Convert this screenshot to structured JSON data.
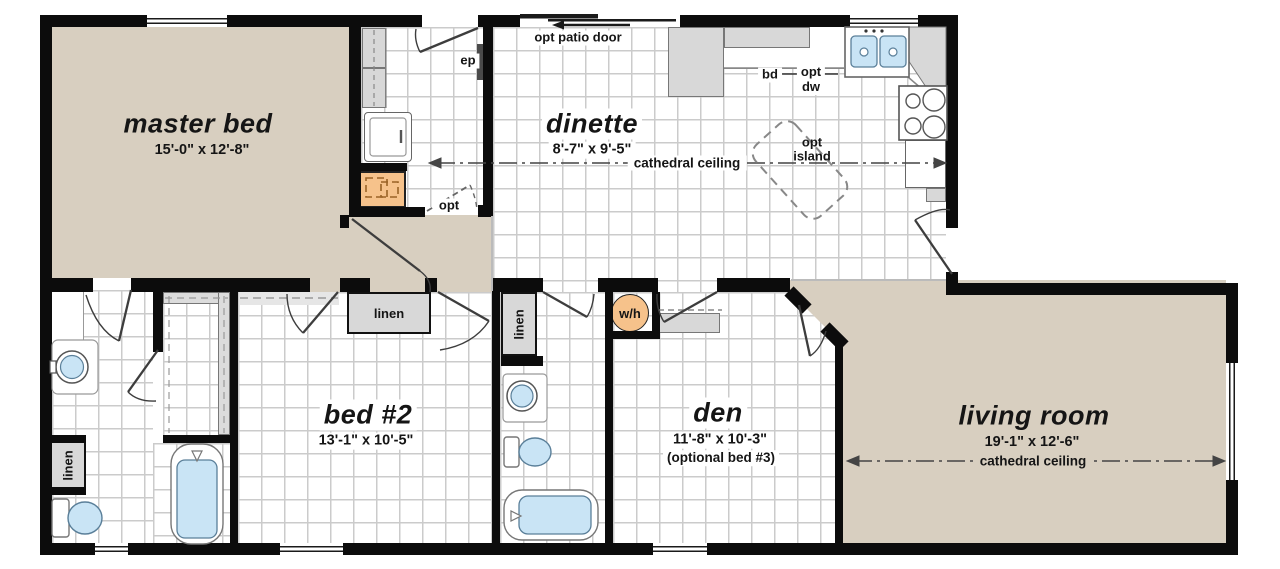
{
  "rooms": {
    "master_bed": {
      "name": "master bed",
      "dims": "15'-0\"  x  12'-8\""
    },
    "dinette": {
      "name": "dinette",
      "dims": "8'-7\"  x  9'-5\""
    },
    "bed2": {
      "name": "bed #2",
      "dims": "13'-1\"  x  10'-5\""
    },
    "den": {
      "name": "den",
      "dims": "11'-8\"  x  10'-3\"",
      "note": "(optional bed #3)"
    },
    "living_room": {
      "name": "living room",
      "dims": "19'-1\"  x  12'-6\""
    }
  },
  "labels": {
    "cathedral_ceiling": "cathedral ceiling",
    "opt_patio_door": "opt patio door",
    "ep": "ep",
    "opt": "opt",
    "bd": "bd",
    "opt_dw_line1": "opt",
    "opt_dw_line2": "dw",
    "opt_island_line1": "opt",
    "opt_island_line2": "island",
    "linen": "linen",
    "water_heater": "w/h"
  },
  "colors": {
    "wall": "#0c0c0c",
    "carpet": "#d8cfc0",
    "tile_line": "#cbcbcb",
    "cabinet_gray": "#d8d8d8",
    "fixture_blue": "#c9e4f5",
    "fixture_orange": "#f6c28b"
  }
}
